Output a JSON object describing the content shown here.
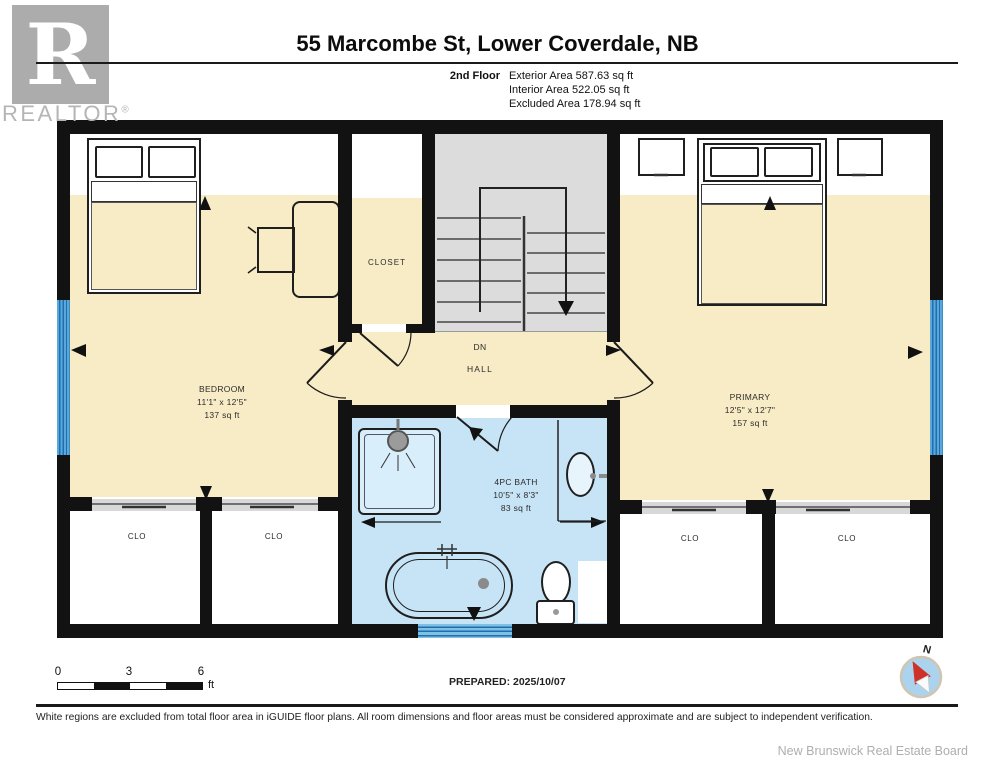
{
  "logo": {
    "letter": "R",
    "brand": "REALTOR",
    "registered": "®"
  },
  "header": {
    "title": "55 Marcombe St, Lower Coverdale, NB",
    "floor_label": "2nd Floor",
    "area_lines": [
      "Exterior Area 587.63 sq ft",
      "Interior Area 522.05 sq ft",
      "Excluded Area 178.94 sq ft"
    ]
  },
  "plan": {
    "bedroom": {
      "name": "BEDROOM",
      "dims": "11'1\" x 12'5\"",
      "area": "137 sq ft"
    },
    "primary": {
      "name": "PRIMARY",
      "dims": "12'5\" x 12'7\"",
      "area": "157 sq ft"
    },
    "bath": {
      "name": "4PC BATH",
      "dims": "10'5\" x 8'3\"",
      "area": "83 sq ft"
    },
    "closet": {
      "name": "CLOSET"
    },
    "hall": {
      "name": "HALL",
      "direction": "DN"
    },
    "clo": {
      "name": "CLO"
    }
  },
  "footer": {
    "scale": {
      "start": "0",
      "mid": "3",
      "end": "6",
      "unit": "ft"
    },
    "prepared": "PREPARED: 2025/10/07",
    "compass_north": "N",
    "disclaimer": "White regions are excluded from total floor area in iGUIDE floor plans. All room dimensions and floor areas must be considered approximate and are subject to independent verification.",
    "attribution": "New Brunswick Real Estate Board"
  },
  "colors": {
    "room_fill": "#F8ECC6",
    "bath_fill": "#C7E4F7",
    "stairs_fill": "#DCDCDC",
    "window_blue": "#4D9FD6",
    "wall": "#121212",
    "compass_fill": "#ABD3EE",
    "needle_red": "#CE3128"
  }
}
